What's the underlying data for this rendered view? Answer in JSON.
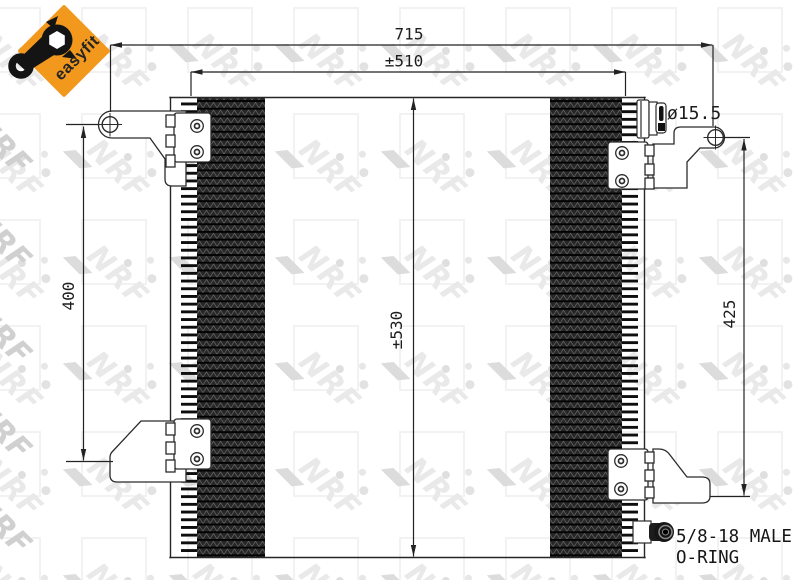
{
  "header_badge": {
    "label": "easyfit"
  },
  "watermark": {
    "text": "NRF"
  },
  "dimensions": {
    "overall_width": "715",
    "core_width": "±510",
    "left_height": "400",
    "core_height": "±530",
    "right_height": "425",
    "hole_diameter": "ø15.5"
  },
  "fitting": {
    "spec_line1": "5/8-18 MALE",
    "spec_line2": "O-RING"
  },
  "colors": {
    "badge_orange": "#F2991D",
    "drawing_line": "#262626",
    "watermark_gray": "#e9e9e9"
  }
}
